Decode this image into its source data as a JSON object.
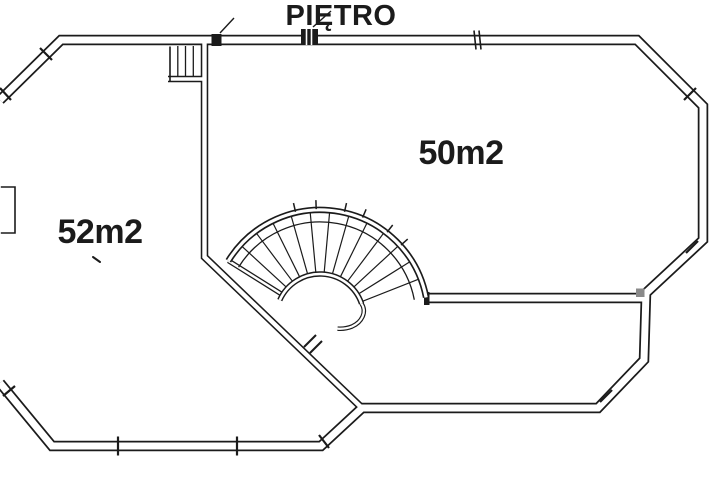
{
  "title": "PIĘTRO",
  "rooms": [
    {
      "id": "left-room",
      "area_label": "52m2"
    },
    {
      "id": "right-room",
      "area_label": "50m2"
    }
  ],
  "colors": {
    "background": "#ffffff",
    "line": "#1b1b1b",
    "junction_block_gray": "#8a8a8a"
  }
}
